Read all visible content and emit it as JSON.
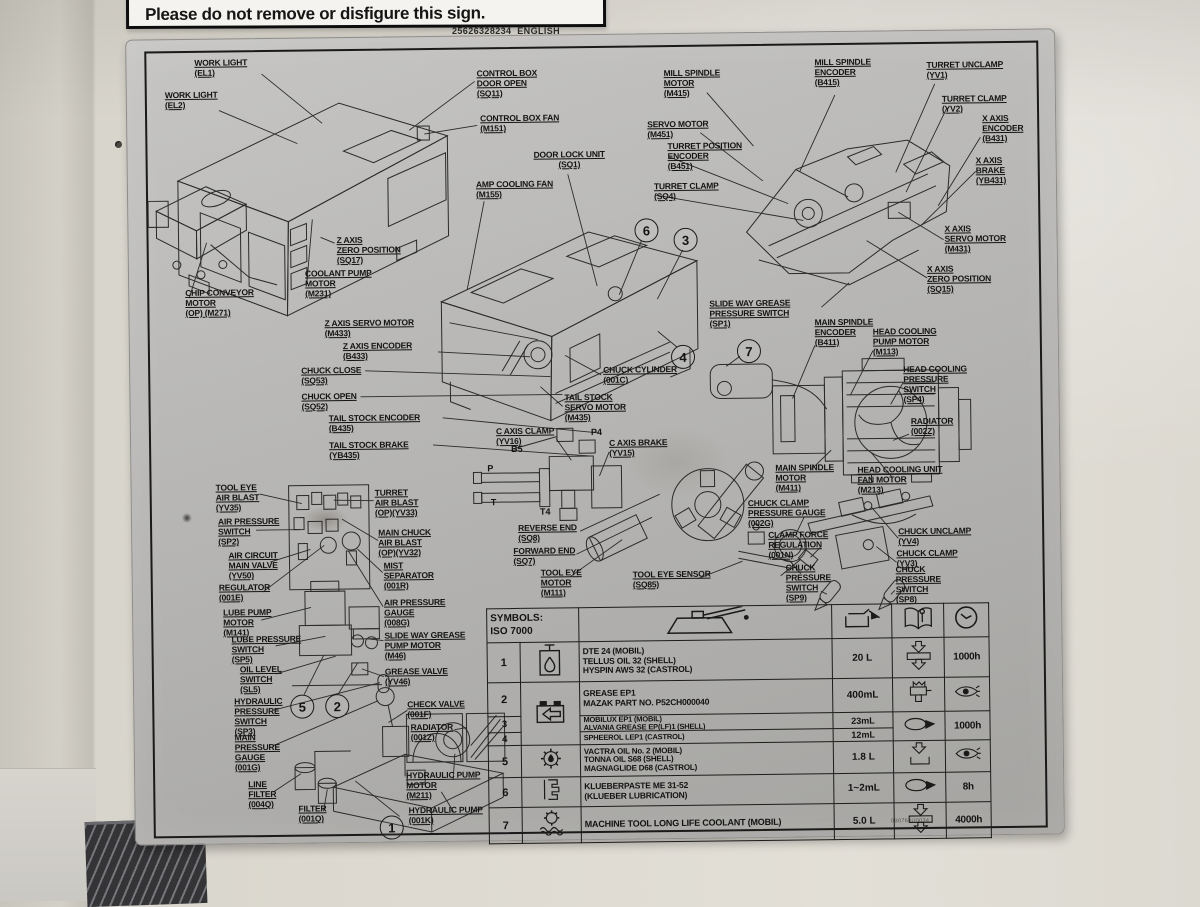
{
  "top_sign": {
    "text": "Please do not remove or disfigure this sign.",
    "code": "25626328234",
    "language": "ENGLISH"
  },
  "plate_part_no": "0B0760U0034",
  "colors": {
    "plate": "#b2b1ae",
    "wall": "#ddd9d0",
    "ink": "#1a1a1a"
  },
  "labels": [
    {
      "id": "work-light-el1",
      "text": "WORK LIGHT\n(EL1)"
    },
    {
      "id": "work-light-el2",
      "text": "WORK LIGHT\n(EL2)"
    },
    {
      "id": "control-box-door-open",
      "text": "CONTROL BOX\nDOOR OPEN\n(SQ11)"
    },
    {
      "id": "control-box-fan",
      "text": "CONTROL BOX FAN\n(M151)"
    },
    {
      "id": "door-lock-unit",
      "text": "DOOR LOCK UNIT\n(SQ1)"
    },
    {
      "id": "amp-cooling-fan",
      "text": "AMP COOLING FAN\n(M155)"
    },
    {
      "id": "mill-spindle-motor",
      "text": "MILL SPINDLE\nMOTOR\n(M415)"
    },
    {
      "id": "mill-spindle-encoder",
      "text": "MILL SPINDLE\nENCODER\n(B415)"
    },
    {
      "id": "turret-unclamp",
      "text": "TURRET UNCLAMP\n(YV1)"
    },
    {
      "id": "turret-clamp-yv2",
      "text": "TURRET CLAMP\n(YV2)"
    },
    {
      "id": "x-axis-encoder",
      "text": "X AXIS\nENCODER\n(B431)"
    },
    {
      "id": "x-axis-brake",
      "text": "X AXIS\nBRAKE\n(YB431)"
    },
    {
      "id": "servo-motor",
      "text": "SERVO MOTOR\n(M451)"
    },
    {
      "id": "turret-position-encoder",
      "text": "TURRET POSITION\nENCODER\n(B451)"
    },
    {
      "id": "turret-clamp-sq4",
      "text": "TURRET CLAMP\n(SQ4)"
    },
    {
      "id": "x-axis-servo-motor",
      "text": "X AXIS\nSERVO MOTOR\n(M431)"
    },
    {
      "id": "x-axis-zero-position",
      "text": "X AXIS\nZERO POSITION\n(SQ15)"
    },
    {
      "id": "z-axis-zero-position",
      "text": "Z AXIS\nZERO POSITION\n(SQ17)"
    },
    {
      "id": "coolant-pump-motor",
      "text": "COOLANT PUMP\nMOTOR\n(M231)"
    },
    {
      "id": "chip-conveyor-motor",
      "text": "CHIP CONVEYOR\nMOTOR\n(OP) (M271)"
    },
    {
      "id": "z-axis-servo-motor",
      "text": "Z AXIS SERVO MOTOR\n(M433)"
    },
    {
      "id": "z-axis-encoder",
      "text": "Z AXIS ENCODER\n(B433)"
    },
    {
      "id": "chuck-close",
      "text": "CHUCK CLOSE\n(SQ53)"
    },
    {
      "id": "chuck-open",
      "text": "CHUCK OPEN\n(SQ52)"
    },
    {
      "id": "tail-stock-encoder",
      "text": "TAIL STOCK ENCODER\n(B435)"
    },
    {
      "id": "tail-stock-brake",
      "text": "TAIL STOCK BRAKE\n(YB435)"
    },
    {
      "id": "slide-way-grease-pressure-switch",
      "text": "SLIDE WAY GREASE\nPRESSURE SWITCH\n(SP1)"
    },
    {
      "id": "main-spindle-encoder",
      "text": "MAIN SPINDLE\nENCODER\n(B411)"
    },
    {
      "id": "head-cooling-pump-motor",
      "text": "HEAD COOLING\nPUMP MOTOR\n(M113)"
    },
    {
      "id": "head-cooling-pressure-switch",
      "text": "HEAD COOLING\nPRESSURE\nSWITCH\n(SP4)"
    },
    {
      "id": "radiator-002z",
      "text": "RADIATOR\n(002Z)"
    },
    {
      "id": "main-spindle-motor",
      "text": "MAIN SPINDLE\nMOTOR\n(M411)"
    },
    {
      "id": "head-cooling-unit-fan-motor",
      "text": "HEAD COOLING UNIT\nFAN MOTOR\n(M213)"
    },
    {
      "id": "chuck-cylinder",
      "text": "CHUCK CYLINDER\n(001C)"
    },
    {
      "id": "tail-stock-servo-motor",
      "text": "TAIL STOCK\nSERVO MOTOR\n(M435)"
    },
    {
      "id": "c-axis-clamp",
      "text": "C AXIS CLAMP\n(YV16)"
    },
    {
      "id": "c-axis-brake",
      "text": "C AXIS BRAKE\n(YV15)"
    },
    {
      "id": "reverse-end",
      "text": "REVERSE END\n(SQ8)"
    },
    {
      "id": "forward-end",
      "text": "FORWARD END\n(SQ7)"
    },
    {
      "id": "tool-eye-motor",
      "text": "TOOL EYE\nMOTOR\n(M111)"
    },
    {
      "id": "tool-eye-sensor",
      "text": "TOOL EYE SENSOR\n(SQ85)"
    },
    {
      "id": "tool-eye-air-blast",
      "text": "TOOL EYE\nAIR BLAST\n(YV35)"
    },
    {
      "id": "air-pressure-switch",
      "text": "AIR PRESSURE\nSWITCH\n(SP2)"
    },
    {
      "id": "air-circuit-main-valve",
      "text": "AIR CIRCUIT\nMAIN VALVE\n(YV50)"
    },
    {
      "id": "regulator",
      "text": "REGULATOR\n(001E)"
    },
    {
      "id": "lube-pump-motor",
      "text": "LUBE PUMP\nMOTOR\n(M141)"
    },
    {
      "id": "lube-pressure-switch",
      "text": "LUBE PRESSURE\nSWITCH\n(SP5)"
    },
    {
      "id": "oil-level-switch",
      "text": "OIL LEVEL\nSWITCH\n(SL5)"
    },
    {
      "id": "turret-air-blast",
      "text": "TURRET\nAIR BLAST\n(OP)(YV33)"
    },
    {
      "id": "main-chuck-air-blast",
      "text": "MAIN CHUCK\nAIR BLAST\n(OP)(YV32)"
    },
    {
      "id": "mist-separator",
      "text": "MIST\nSEPARATOR\n(001R)"
    },
    {
      "id": "air-pressure-gauge",
      "text": "AIR PRESSURE\nGAUGE\n(008G)"
    },
    {
      "id": "slide-way-grease-pump-motor",
      "text": "SLIDE WAY GREASE\nPUMP MOTOR\n(M46)"
    },
    {
      "id": "grease-valve",
      "text": "GREASE VALVE\n(YV46)"
    },
    {
      "id": "hydraulic-pressure-switch",
      "text": "HYDRAULIC\nPRESSURE\nSWITCH\n(SP3)"
    },
    {
      "id": "main-pressure-gauge",
      "text": "MAIN\nPRESSURE\nGAUGE\n(001G)"
    },
    {
      "id": "line-filter",
      "text": "LINE\nFILTER\n(004Q)"
    },
    {
      "id": "filter",
      "text": "FILTER\n(001Q)"
    },
    {
      "id": "check-valve",
      "text": "CHECK VALVE\n(001F)"
    },
    {
      "id": "radiator-001z",
      "text": "RADIATOR\n(001Z)"
    },
    {
      "id": "hydraulic-pump-motor",
      "text": "HYDRAULIC PUMP\nMOTOR\n(M211)"
    },
    {
      "id": "hydraulic-pump",
      "text": "HYDRAULIC PUMP\n(001K)"
    },
    {
      "id": "chuck-clamp-pressure-gauge",
      "text": "CHUCK CLAMP\nPRESSURE GAUGE\n(002G)"
    },
    {
      "id": "clamp-force-regulation",
      "text": "CLAMP FORCE\nREGULATION\n(001N)"
    },
    {
      "id": "chuck-pressure-switch-sp9",
      "text": "CHUCK\nPRESSURE\nSWITCH\n(SP9)"
    },
    {
      "id": "chuck-unclamp",
      "text": "CHUCK UNCLAMP\n(YV4)"
    },
    {
      "id": "chuck-clamp-yv3",
      "text": "CHUCK CLAMP\n(YV3)"
    },
    {
      "id": "chuck-pressure-switch-sp8",
      "text": "CHUCK\nPRESSURE\nSWITCH\n(SP8)"
    }
  ],
  "ports": [
    {
      "id": "port-p4",
      "text": "P4"
    },
    {
      "id": "port-b5",
      "text": "B5"
    },
    {
      "id": "port-p",
      "text": "P"
    },
    {
      "id": "port-t",
      "text": "T"
    },
    {
      "id": "port-t4",
      "text": "T4"
    }
  ],
  "callouts": [
    "6",
    "3",
    "4",
    "7",
    "5",
    "2",
    "1"
  ],
  "table": {
    "header": {
      "title": "SYMBOLS:\nISO 7000"
    },
    "rows": [
      {
        "no": "1",
        "name": "DTE 24 (MOBIL)\nTELLUS OIL 32 (SHELL)\nHYSPIN AWS 32 (CASTROL)",
        "qty": "20 L",
        "interval": "1000h"
      },
      {
        "no": "2",
        "name": "GREASE EP1\nMAZAK PART NO. P52CH000040",
        "qty": "400mL"
      },
      {
        "no": "3",
        "name": "MOBILUX EP1 (MOBIL)\nALVANIA GREASE EP(LF)1 (SHELL)",
        "qty": "23mL",
        "interval": "1000h"
      },
      {
        "no": "4",
        "name": "SPHEEROL LEP1 (CASTROL)",
        "qty": "12mL"
      },
      {
        "no": "5",
        "name": "VACTRA OIL No. 2 (MOBIL)\nTONNA OIL S68 (SHELL)\nMAGNAGLIDE D68 (CASTROL)",
        "qty": "1.8 L"
      },
      {
        "no": "6",
        "name": "KLUEBERPASTE ME 31-52\n(KLUEBER LUBRICATION)",
        "qty": "1~2mL",
        "interval": "8h"
      },
      {
        "no": "7",
        "name": "MACHINE TOOL LONG LIFE COOLANT (MOBIL)",
        "qty": "5.0 L",
        "interval": "4000h"
      }
    ]
  }
}
